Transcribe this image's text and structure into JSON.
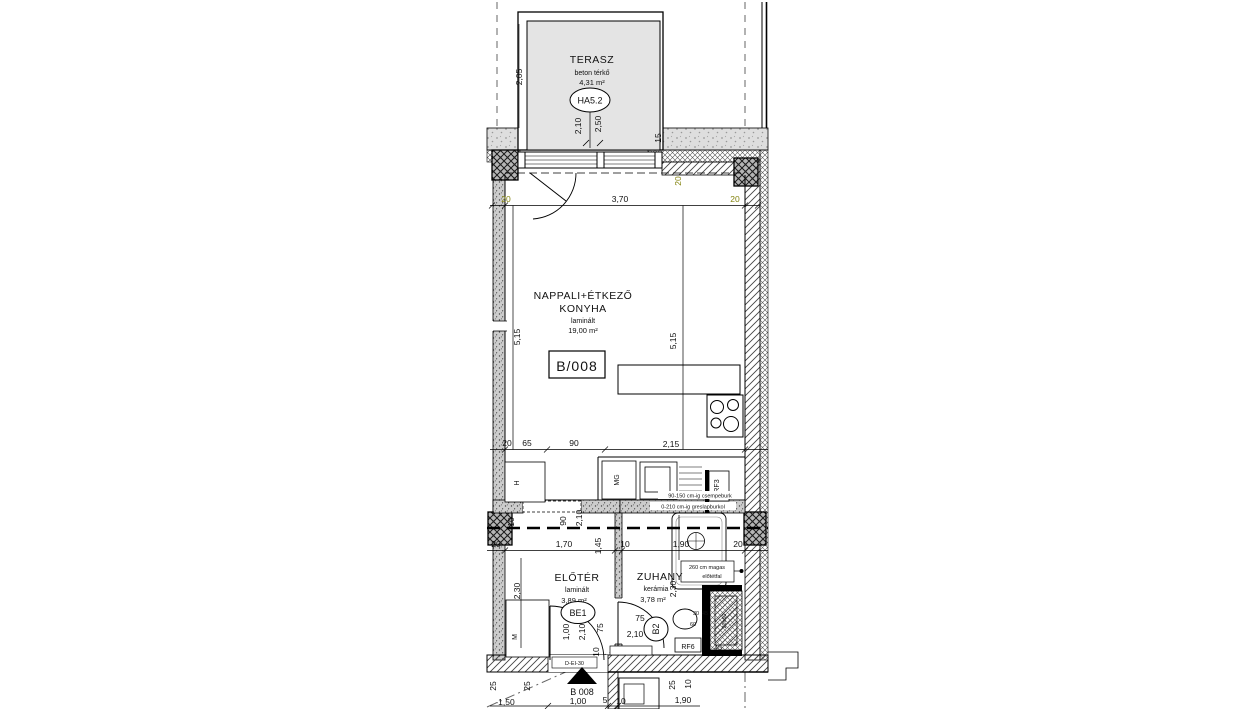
{
  "colors": {
    "terrace_fill": "#e4e4e4",
    "band_fill": "#dedede",
    "line": "#000000",
    "dim_accent": "#83830e"
  },
  "terrace": {
    "name": "TERASZ",
    "finish": "beton térkő",
    "area": "4,31 m²",
    "tag": "HA5.2"
  },
  "living": {
    "name1": "NAPPALI+ÉTKEZŐ",
    "name2": "KONYHA",
    "finish": "laminált",
    "area": "19,00 m²",
    "unit": "B/008"
  },
  "hall": {
    "name": "ELŐTÉR",
    "finish": "laminált",
    "area": "3,89 m²",
    "door_tag": "BE1"
  },
  "shower": {
    "name": "ZUHANY",
    "finish": "kerámia",
    "area": "3,78 m²",
    "door_tag": "B2"
  },
  "fixtures": {
    "dishwasher": "MG",
    "fridge": "H",
    "washer": "M",
    "rf3": "RF3",
    "rf6": "RF6",
    "shaft": "20x60"
  },
  "notes": {
    "kitchen_tiles": "90-150 cm-ig csempeburk",
    "shower_tiles": "0-210 cm-ig greslapburkol",
    "stub_wall_1": "260 cm magas",
    "stub_wall_2": "előtétfal",
    "fire_door": "D-EI-30",
    "entry_label": "B 008",
    "level": "-1,50"
  },
  "dims": {
    "top_left": "20",
    "top_span": "3,70",
    "top_right": "20",
    "corner": "20",
    "height_left": "5,15",
    "height_right": "5,15",
    "terrace_h": "2,05",
    "terrace_d": "2,10",
    "terrace_w": "2,50",
    "band": "15",
    "kitchen_20": "20",
    "kitchen_65": "65",
    "kitchen_90": "90",
    "kitchen_215": "2,15",
    "open_10": "10",
    "open_90": "90",
    "open_210": "2,10",
    "open_145": "1,45",
    "row_20l": "20",
    "row_170": "1,70",
    "row_10": "10",
    "row_190": "1,90",
    "row_20r": "20",
    "hall_230": "2,30",
    "shower_230": "2,30",
    "entry_100": "1,00",
    "entry_210": "2,10",
    "entry_10": "10",
    "entry_75": "75",
    "b2_75": "75",
    "b2_210": "2,10",
    "wb_30": "30",
    "wb_45": "45",
    "wb_60": "60",
    "shaft_45": "45",
    "bot_25a": "25",
    "bot_25b": "25",
    "bot_25r": "25",
    "bot_10r": "10",
    "bot_100": "1,00",
    "bot_5": "5",
    "bot_10": "10",
    "bot_190": "1,90"
  }
}
